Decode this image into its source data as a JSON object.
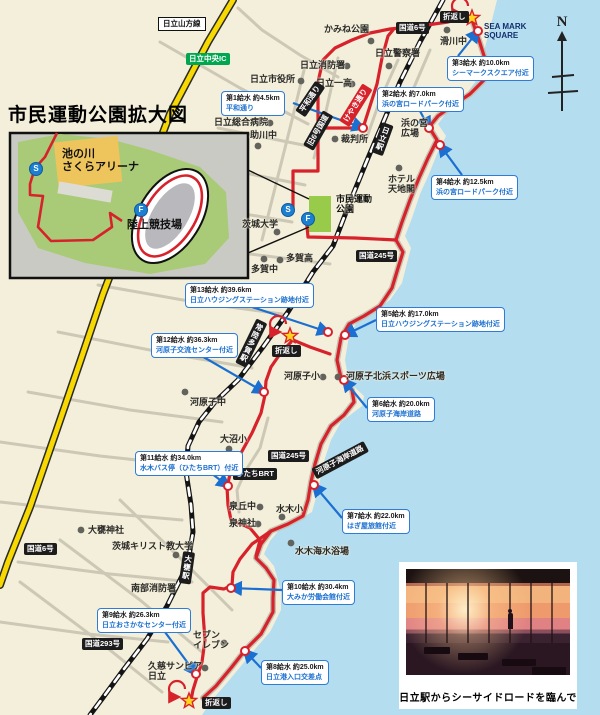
{
  "title": "市民運動公園拡大図",
  "compass_label": "N",
  "colors": {
    "sea": "#b4ddf0",
    "land": "#f4efda",
    "course": "#d7222b",
    "arrow_blue": "#1a6fd0",
    "park_green": "#98cb4a",
    "expressway_yellow": "#f7d800"
  },
  "inset": {
    "arena": "池の川\nさくらアリーナ",
    "stadium": "陸上競技場",
    "start_label": "S",
    "finish_label": "F"
  },
  "park": {
    "name": "市民運動\n公園",
    "start_label": "S",
    "finish_label": "F"
  },
  "turnaround_label": "折返し",
  "turnarounds": [
    {
      "bx": 440,
      "by": 11,
      "sx": 472,
      "sy": 18
    },
    {
      "bx": 272,
      "by": 345,
      "sx": 290,
      "sy": 336
    },
    {
      "bx": 202,
      "by": 697,
      "sx": 189,
      "sy": 701
    }
  ],
  "road_badges": [
    {
      "t": "国道6号",
      "x": 396,
      "y": 22,
      "cls": "b-black",
      "rot": 0
    },
    {
      "t": "国道6号",
      "x": 24,
      "y": 543,
      "cls": "b-black",
      "rot": 0
    },
    {
      "t": "国道245号",
      "x": 356,
      "y": 250,
      "cls": "b-black",
      "rot": 0
    },
    {
      "t": "国道245号",
      "x": 268,
      "y": 450,
      "cls": "b-black",
      "rot": 0
    },
    {
      "t": "国道293号",
      "x": 82,
      "y": 638,
      "cls": "b-black",
      "rot": 0
    },
    {
      "t": "ひたちBRT",
      "x": 233,
      "y": 468,
      "cls": "b-black",
      "rot": 0
    },
    {
      "t": "河原子海岸道路",
      "x": 314,
      "y": 468,
      "cls": "b-black",
      "rot": -28
    },
    {
      "t": "平和通り",
      "x": 300,
      "y": 108,
      "cls": "b-black",
      "rot": -56
    },
    {
      "t": "旧6号国道",
      "x": 308,
      "y": 142,
      "cls": "b-black",
      "rot": -60
    },
    {
      "t": "けやき通り",
      "x": 344,
      "y": 118,
      "cls": "b-red",
      "rot": -58
    },
    {
      "t": "日立中央IC",
      "x": 186,
      "y": 53,
      "cls": "b-green",
      "rot": 0
    },
    {
      "t": "日立山方線",
      "x": 158,
      "y": 17,
      "cls": "b-white",
      "rot": 0
    },
    {
      "t": "日立駅",
      "x": 377,
      "y": 121,
      "cls": "b-black b-vert",
      "rot": 20
    },
    {
      "t": "常陸多賀駅",
      "x": 246,
      "y": 316,
      "cls": "b-black b-vert",
      "rot": 26
    },
    {
      "t": "大甕駅",
      "x": 181,
      "y": 551,
      "cls": "b-black b-vert",
      "rot": 8
    }
  ],
  "places": [
    {
      "t": "日立市役所",
      "x": 250,
      "y": 74,
      "dx": 301,
      "dy": 81
    },
    {
      "t": "かみね公園",
      "x": 324,
      "y": 24,
      "dx": 371,
      "dy": 41
    },
    {
      "t": "日立消防署",
      "x": 300,
      "y": 60,
      "dx": 347,
      "dy": 66
    },
    {
      "t": "日立警察署",
      "x": 375,
      "y": 48,
      "dx": 389,
      "dy": 66
    },
    {
      "t": "日立一高",
      "x": 316,
      "y": 78,
      "dx": 352,
      "dy": 84
    },
    {
      "t": "滑川中",
      "x": 440,
      "y": 36,
      "dx": 447,
      "dy": 30
    },
    {
      "t": "SEA MARK\nSQUARE",
      "x": 484,
      "y": 22,
      "cls": "smq"
    },
    {
      "t": "日立総合病院",
      "x": 214,
      "y": 117,
      "dx": 270,
      "dy": 123
    },
    {
      "t": "助川中",
      "x": 250,
      "y": 130,
      "dx": 258,
      "dy": 146
    },
    {
      "t": "裁判所",
      "x": 341,
      "y": 134,
      "dx": 335,
      "dy": 139
    },
    {
      "t": "浜の宮\n広場",
      "x": 401,
      "y": 118
    },
    {
      "t": "ホテル\n天地閣",
      "x": 388,
      "y": 174,
      "dx": 399,
      "dy": 168
    },
    {
      "t": "市民運動\n公園",
      "x": 336,
      "y": 194,
      "cls": "parkname"
    },
    {
      "t": "茨城大学",
      "x": 242,
      "y": 219,
      "dx": 277,
      "dy": 232
    },
    {
      "t": "多賀高",
      "x": 286,
      "y": 253,
      "dx": 280,
      "dy": 260
    },
    {
      "t": "多賀中",
      "x": 251,
      "y": 264,
      "dx": 264,
      "dy": 259
    },
    {
      "t": "河原子小",
      "x": 284,
      "y": 371,
      "dx": 323,
      "dy": 377
    },
    {
      "t": "河原子北浜スポーツ広場",
      "x": 346,
      "y": 371,
      "dx": 338,
      "dy": 377
    },
    {
      "t": "河原子中",
      "x": 190,
      "y": 397,
      "dx": 185,
      "dy": 392
    },
    {
      "t": "大沼小",
      "x": 220,
      "y": 434,
      "dx": 229,
      "dy": 449
    },
    {
      "t": "泉丘中",
      "x": 229,
      "y": 501,
      "dx": 260,
      "dy": 507
    },
    {
      "t": "泉神社",
      "x": 229,
      "y": 518,
      "dx": 258,
      "dy": 524
    },
    {
      "t": "水木小",
      "x": 276,
      "y": 504,
      "dx": 282,
      "dy": 517
    },
    {
      "t": "水木海水浴場",
      "x": 295,
      "y": 546,
      "dx": 291,
      "dy": 543
    },
    {
      "t": "茨城キリスト教大学",
      "x": 112,
      "y": 541,
      "dx": 176,
      "dy": 555
    },
    {
      "t": "大甕神社",
      "x": 88,
      "y": 525,
      "dx": 81,
      "dy": 530
    },
    {
      "t": "南部消防署",
      "x": 131,
      "y": 583,
      "dx": 172,
      "dy": 590
    },
    {
      "t": "セブン\nイレブン",
      "x": 193,
      "y": 630,
      "dx": 224,
      "dy": 643
    },
    {
      "t": "久慈サンピア\n日立",
      "x": 148,
      "y": 661,
      "dx": 205,
      "dy": 668
    }
  ],
  "water_stations": [
    {
      "l1": "第1給水 約4.5km",
      "l2": "平和通り",
      "bx": 221,
      "by": 91,
      "ax": 293,
      "ay": 103,
      "cx": 363,
      "cy": 128
    },
    {
      "l1": "第2給水 約7.0km",
      "l2": "浜の宮ロードパーク付近",
      "bx": 377,
      "by": 87,
      "ax": 420,
      "ay": 111,
      "cx": 429,
      "cy": 128
    },
    {
      "l1": "第3給水 約10.0km",
      "l2": "シーマークスクエア付近",
      "bx": 447,
      "by": 56,
      "ax": 458,
      "ay": 56,
      "cx": 478,
      "cy": 31
    },
    {
      "l1": "第4給水 約12.5km",
      "l2": "浜の宮ロードパーク付近",
      "bx": 431,
      "by": 175,
      "ax": 462,
      "ay": 175,
      "cx": 440,
      "cy": 145
    },
    {
      "l1": "第5給水 約17.0km",
      "l2": "日立ハウジングステーション跡地付近",
      "bx": 376,
      "by": 307,
      "ax": 376,
      "ay": 320,
      "cx": 345,
      "cy": 335
    },
    {
      "l1": "第6給水 約20.0km",
      "l2": "河原子海岸道路",
      "bx": 367,
      "by": 397,
      "ax": 367,
      "ay": 408,
      "cx": 344,
      "cy": 380
    },
    {
      "l1": "第7給水 約22.0km",
      "l2": "はぎ屋旅館付近",
      "bx": 342,
      "by": 509,
      "ax": 342,
      "ay": 518,
      "cx": 314,
      "cy": 485
    },
    {
      "l1": "第8給水 約25.0km",
      "l2": "日立港入口交差点",
      "bx": 261,
      "by": 660,
      "ax": 261,
      "ay": 668,
      "cx": 245,
      "cy": 651
    },
    {
      "l1": "第9給水 約26.3km",
      "l2": "日立おさかなセンター付近",
      "bx": 97,
      "by": 608,
      "ax": 162,
      "ay": 628,
      "cx": 196,
      "cy": 674
    },
    {
      "l1": "第10給水 約30.4km",
      "l2": "大みか労働会館付近",
      "bx": 282,
      "by": 580,
      "ax": 282,
      "ay": 590,
      "cx": 231,
      "cy": 588
    },
    {
      "l1": "第11給水 約34.0km",
      "l2": "水木バス停（ひたちBRT）付近",
      "bx": 135,
      "by": 451,
      "ax": 207,
      "ay": 470,
      "cx": 228,
      "cy": 486
    },
    {
      "l1": "第12給水 約36.3km",
      "l2": "河原子交流センター付近",
      "bx": 151,
      "by": 333,
      "ax": 200,
      "ay": 355,
      "cx": 264,
      "cy": 392
    },
    {
      "l1": "第13給水 約39.6km",
      "l2": "日立ハウジングステーション跡地付近",
      "bx": 185,
      "by": 283,
      "ax": 240,
      "ay": 303,
      "cx": 328,
      "cy": 332
    }
  ],
  "photo": {
    "caption": "日立駅からシーサイドロードを臨んで"
  }
}
